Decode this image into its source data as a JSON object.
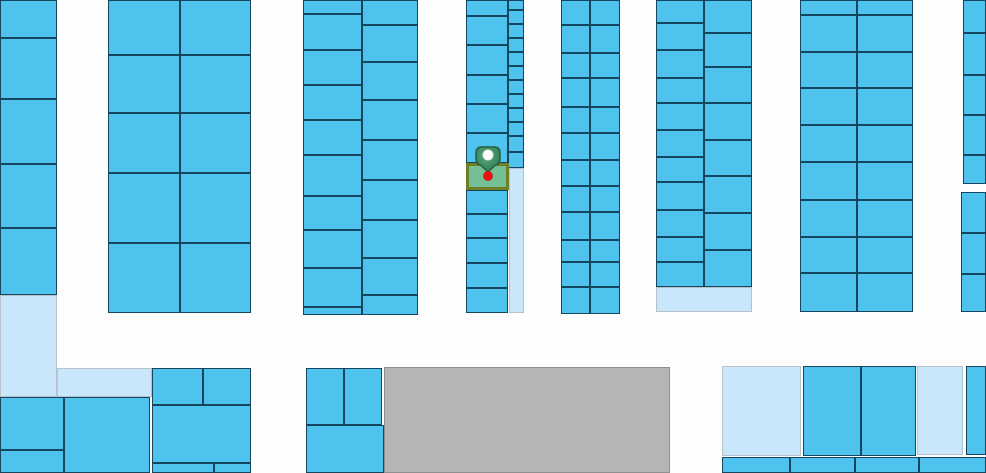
{
  "map": {
    "canvas": {
      "width": 986,
      "height": 473
    },
    "colors": {
      "road": "#fdfdfd",
      "parcel_fill": "#4dc3ee",
      "parcel_border": "#15465e",
      "pale_fill": "#c9e7fb",
      "pale_border": "#b6c3cc",
      "gray_fill": "#b5b5b5",
      "gray_border": "#909090",
      "selected_fill": "#74bf96",
      "selected_border": "#6f7f23",
      "marker_green_light": "#5fae83",
      "marker_green_dark": "#2d6f4c",
      "marker_outline": "#245c3e",
      "marker_circle": "#fdfdfd",
      "marker_dot_red": "#ef1010"
    },
    "marker": {
      "x": 470,
      "y": 142,
      "width": 36,
      "height": 44
    },
    "parcels": [
      [
        0,
        0,
        57,
        38,
        "b"
      ],
      [
        0,
        38,
        57,
        61,
        "b"
      ],
      [
        0,
        99,
        57,
        65,
        "b"
      ],
      [
        0,
        164,
        57,
        64,
        "b"
      ],
      [
        0,
        228,
        57,
        67,
        "b"
      ],
      [
        0,
        295,
        57,
        102,
        "p"
      ],
      [
        57,
        368,
        95,
        29,
        "p"
      ],
      [
        0,
        397,
        64,
        53,
        "b"
      ],
      [
        0,
        450,
        64,
        23,
        "b"
      ],
      [
        64,
        397,
        86,
        76,
        "b"
      ],
      [
        152,
        368,
        51,
        37,
        "b"
      ],
      [
        203,
        368,
        48,
        37,
        "b"
      ],
      [
        152,
        405,
        99,
        58,
        "b"
      ],
      [
        152,
        463,
        62,
        10,
        "b"
      ],
      [
        214,
        463,
        37,
        10,
        "b"
      ],
      [
        108,
        0,
        72,
        55,
        "b"
      ],
      [
        108,
        55,
        72,
        58,
        "b"
      ],
      [
        108,
        113,
        72,
        60,
        "b"
      ],
      [
        108,
        173,
        72,
        70,
        "b"
      ],
      [
        108,
        243,
        72,
        70,
        "b"
      ],
      [
        180,
        0,
        71,
        55,
        "b"
      ],
      [
        180,
        55,
        71,
        58,
        "b"
      ],
      [
        180,
        113,
        71,
        60,
        "b"
      ],
      [
        180,
        173,
        71,
        70,
        "b"
      ],
      [
        180,
        243,
        71,
        70,
        "b"
      ],
      [
        303,
        0,
        59,
        14,
        "b"
      ],
      [
        303,
        14,
        59,
        36,
        "b"
      ],
      [
        303,
        50,
        59,
        35,
        "b"
      ],
      [
        303,
        85,
        59,
        35,
        "b"
      ],
      [
        303,
        120,
        59,
        35,
        "b"
      ],
      [
        303,
        155,
        59,
        41,
        "b"
      ],
      [
        303,
        196,
        59,
        34,
        "b"
      ],
      [
        303,
        230,
        59,
        38,
        "b"
      ],
      [
        303,
        268,
        59,
        39,
        "b"
      ],
      [
        303,
        307,
        59,
        8,
        "b"
      ],
      [
        362,
        0,
        56,
        25,
        "b"
      ],
      [
        362,
        25,
        56,
        37,
        "b"
      ],
      [
        362,
        62,
        56,
        38,
        "b"
      ],
      [
        362,
        100,
        56,
        40,
        "b"
      ],
      [
        362,
        140,
        56,
        40,
        "b"
      ],
      [
        362,
        180,
        56,
        40,
        "b"
      ],
      [
        362,
        220,
        56,
        38,
        "b"
      ],
      [
        362,
        258,
        56,
        37,
        "b"
      ],
      [
        362,
        295,
        56,
        20,
        "b"
      ],
      [
        466,
        0,
        42,
        16,
        "b"
      ],
      [
        466,
        16,
        42,
        29,
        "b"
      ],
      [
        466,
        45,
        42,
        30,
        "b"
      ],
      [
        466,
        75,
        42,
        29,
        "b"
      ],
      [
        466,
        104,
        42,
        29,
        "b"
      ],
      [
        466,
        133,
        42,
        30,
        "b"
      ],
      [
        466,
        190,
        42,
        24,
        "b"
      ],
      [
        466,
        214,
        42,
        24,
        "b"
      ],
      [
        466,
        238,
        42,
        25,
        "b"
      ],
      [
        466,
        263,
        42,
        25,
        "b"
      ],
      [
        466,
        288,
        42,
        25,
        "b"
      ],
      [
        508,
        0,
        16,
        10,
        "b"
      ],
      [
        508,
        10,
        16,
        14,
        "b"
      ],
      [
        508,
        24,
        16,
        14,
        "b"
      ],
      [
        508,
        38,
        16,
        14,
        "b"
      ],
      [
        508,
        52,
        16,
        14,
        "b"
      ],
      [
        508,
        66,
        16,
        14,
        "b"
      ],
      [
        508,
        80,
        16,
        14,
        "b"
      ],
      [
        508,
        94,
        16,
        14,
        "b"
      ],
      [
        508,
        108,
        16,
        14,
        "b"
      ],
      [
        508,
        122,
        16,
        14,
        "b"
      ],
      [
        508,
        136,
        16,
        16,
        "b"
      ],
      [
        508,
        152,
        16,
        16,
        "b"
      ],
      [
        509,
        168,
        15,
        145,
        "p"
      ],
      [
        561,
        0,
        29,
        25,
        "b"
      ],
      [
        561,
        25,
        29,
        28,
        "b"
      ],
      [
        561,
        53,
        29,
        25,
        "b"
      ],
      [
        561,
        78,
        29,
        29,
        "b"
      ],
      [
        561,
        107,
        29,
        26,
        "b"
      ],
      [
        561,
        133,
        29,
        27,
        "b"
      ],
      [
        561,
        160,
        29,
        26,
        "b"
      ],
      [
        561,
        186,
        29,
        26,
        "b"
      ],
      [
        561,
        212,
        29,
        28,
        "b"
      ],
      [
        561,
        240,
        29,
        22,
        "b"
      ],
      [
        561,
        262,
        29,
        25,
        "b"
      ],
      [
        561,
        287,
        29,
        27,
        "b"
      ],
      [
        590,
        0,
        30,
        25,
        "b"
      ],
      [
        590,
        25,
        30,
        28,
        "b"
      ],
      [
        590,
        53,
        30,
        25,
        "b"
      ],
      [
        590,
        78,
        30,
        29,
        "b"
      ],
      [
        590,
        107,
        30,
        26,
        "b"
      ],
      [
        590,
        133,
        30,
        27,
        "b"
      ],
      [
        590,
        160,
        30,
        26,
        "b"
      ],
      [
        590,
        186,
        30,
        26,
        "b"
      ],
      [
        590,
        212,
        30,
        28,
        "b"
      ],
      [
        590,
        240,
        30,
        22,
        "b"
      ],
      [
        590,
        262,
        30,
        25,
        "b"
      ],
      [
        590,
        287,
        30,
        27,
        "b"
      ],
      [
        656,
        0,
        48,
        23,
        "b"
      ],
      [
        656,
        23,
        48,
        27,
        "b"
      ],
      [
        656,
        50,
        48,
        28,
        "b"
      ],
      [
        656,
        78,
        48,
        25,
        "b"
      ],
      [
        656,
        103,
        48,
        27,
        "b"
      ],
      [
        656,
        130,
        48,
        27,
        "b"
      ],
      [
        656,
        157,
        48,
        25,
        "b"
      ],
      [
        656,
        182,
        48,
        28,
        "b"
      ],
      [
        656,
        210,
        48,
        27,
        "b"
      ],
      [
        656,
        237,
        48,
        25,
        "b"
      ],
      [
        656,
        262,
        48,
        25,
        "b"
      ],
      [
        704,
        0,
        48,
        33,
        "b"
      ],
      [
        704,
        33,
        48,
        34,
        "b"
      ],
      [
        704,
        67,
        48,
        36,
        "b"
      ],
      [
        704,
        103,
        48,
        37,
        "b"
      ],
      [
        704,
        140,
        48,
        36,
        "b"
      ],
      [
        704,
        176,
        48,
        37,
        "b"
      ],
      [
        704,
        213,
        48,
        37,
        "b"
      ],
      [
        704,
        250,
        48,
        37,
        "b"
      ],
      [
        656,
        287,
        96,
        25,
        "p"
      ],
      [
        800,
        0,
        57,
        15,
        "b"
      ],
      [
        800,
        15,
        57,
        37,
        "b"
      ],
      [
        800,
        52,
        57,
        36,
        "b"
      ],
      [
        800,
        88,
        57,
        37,
        "b"
      ],
      [
        800,
        125,
        57,
        37,
        "b"
      ],
      [
        800,
        162,
        57,
        38,
        "b"
      ],
      [
        800,
        200,
        57,
        37,
        "b"
      ],
      [
        800,
        237,
        57,
        36,
        "b"
      ],
      [
        800,
        273,
        57,
        39,
        "b"
      ],
      [
        857,
        0,
        56,
        15,
        "b"
      ],
      [
        857,
        15,
        56,
        37,
        "b"
      ],
      [
        857,
        52,
        56,
        36,
        "b"
      ],
      [
        857,
        88,
        56,
        37,
        "b"
      ],
      [
        857,
        125,
        56,
        37,
        "b"
      ],
      [
        857,
        162,
        56,
        38,
        "b"
      ],
      [
        857,
        200,
        56,
        37,
        "b"
      ],
      [
        857,
        237,
        56,
        36,
        "b"
      ],
      [
        857,
        273,
        56,
        39,
        "b"
      ],
      [
        963,
        0,
        23,
        33,
        "b"
      ],
      [
        963,
        33,
        23,
        42,
        "b"
      ],
      [
        963,
        75,
        23,
        40,
        "b"
      ],
      [
        963,
        115,
        23,
        40,
        "b"
      ],
      [
        963,
        155,
        23,
        29,
        "b"
      ],
      [
        961,
        192,
        25,
        41,
        "b"
      ],
      [
        961,
        233,
        25,
        41,
        "b"
      ],
      [
        961,
        274,
        25,
        38,
        "b"
      ],
      [
        306,
        368,
        38,
        57,
        "b"
      ],
      [
        344,
        368,
        38,
        57,
        "b"
      ],
      [
        306,
        425,
        78,
        48,
        "b"
      ],
      [
        384,
        367,
        286,
        106,
        "g"
      ],
      [
        722,
        366,
        79,
        90,
        "p"
      ],
      [
        803,
        366,
        58,
        90,
        "b"
      ],
      [
        861,
        366,
        55,
        90,
        "b"
      ],
      [
        917,
        366,
        46,
        89,
        "p"
      ],
      [
        966,
        366,
        20,
        89,
        "b"
      ],
      [
        722,
        457,
        68,
        16,
        "b"
      ],
      [
        790,
        457,
        65,
        16,
        "b"
      ],
      [
        855,
        457,
        64,
        16,
        "b"
      ],
      [
        919,
        457,
        67,
        16,
        "b"
      ],
      [
        466,
        163,
        43,
        27,
        "s"
      ]
    ]
  }
}
